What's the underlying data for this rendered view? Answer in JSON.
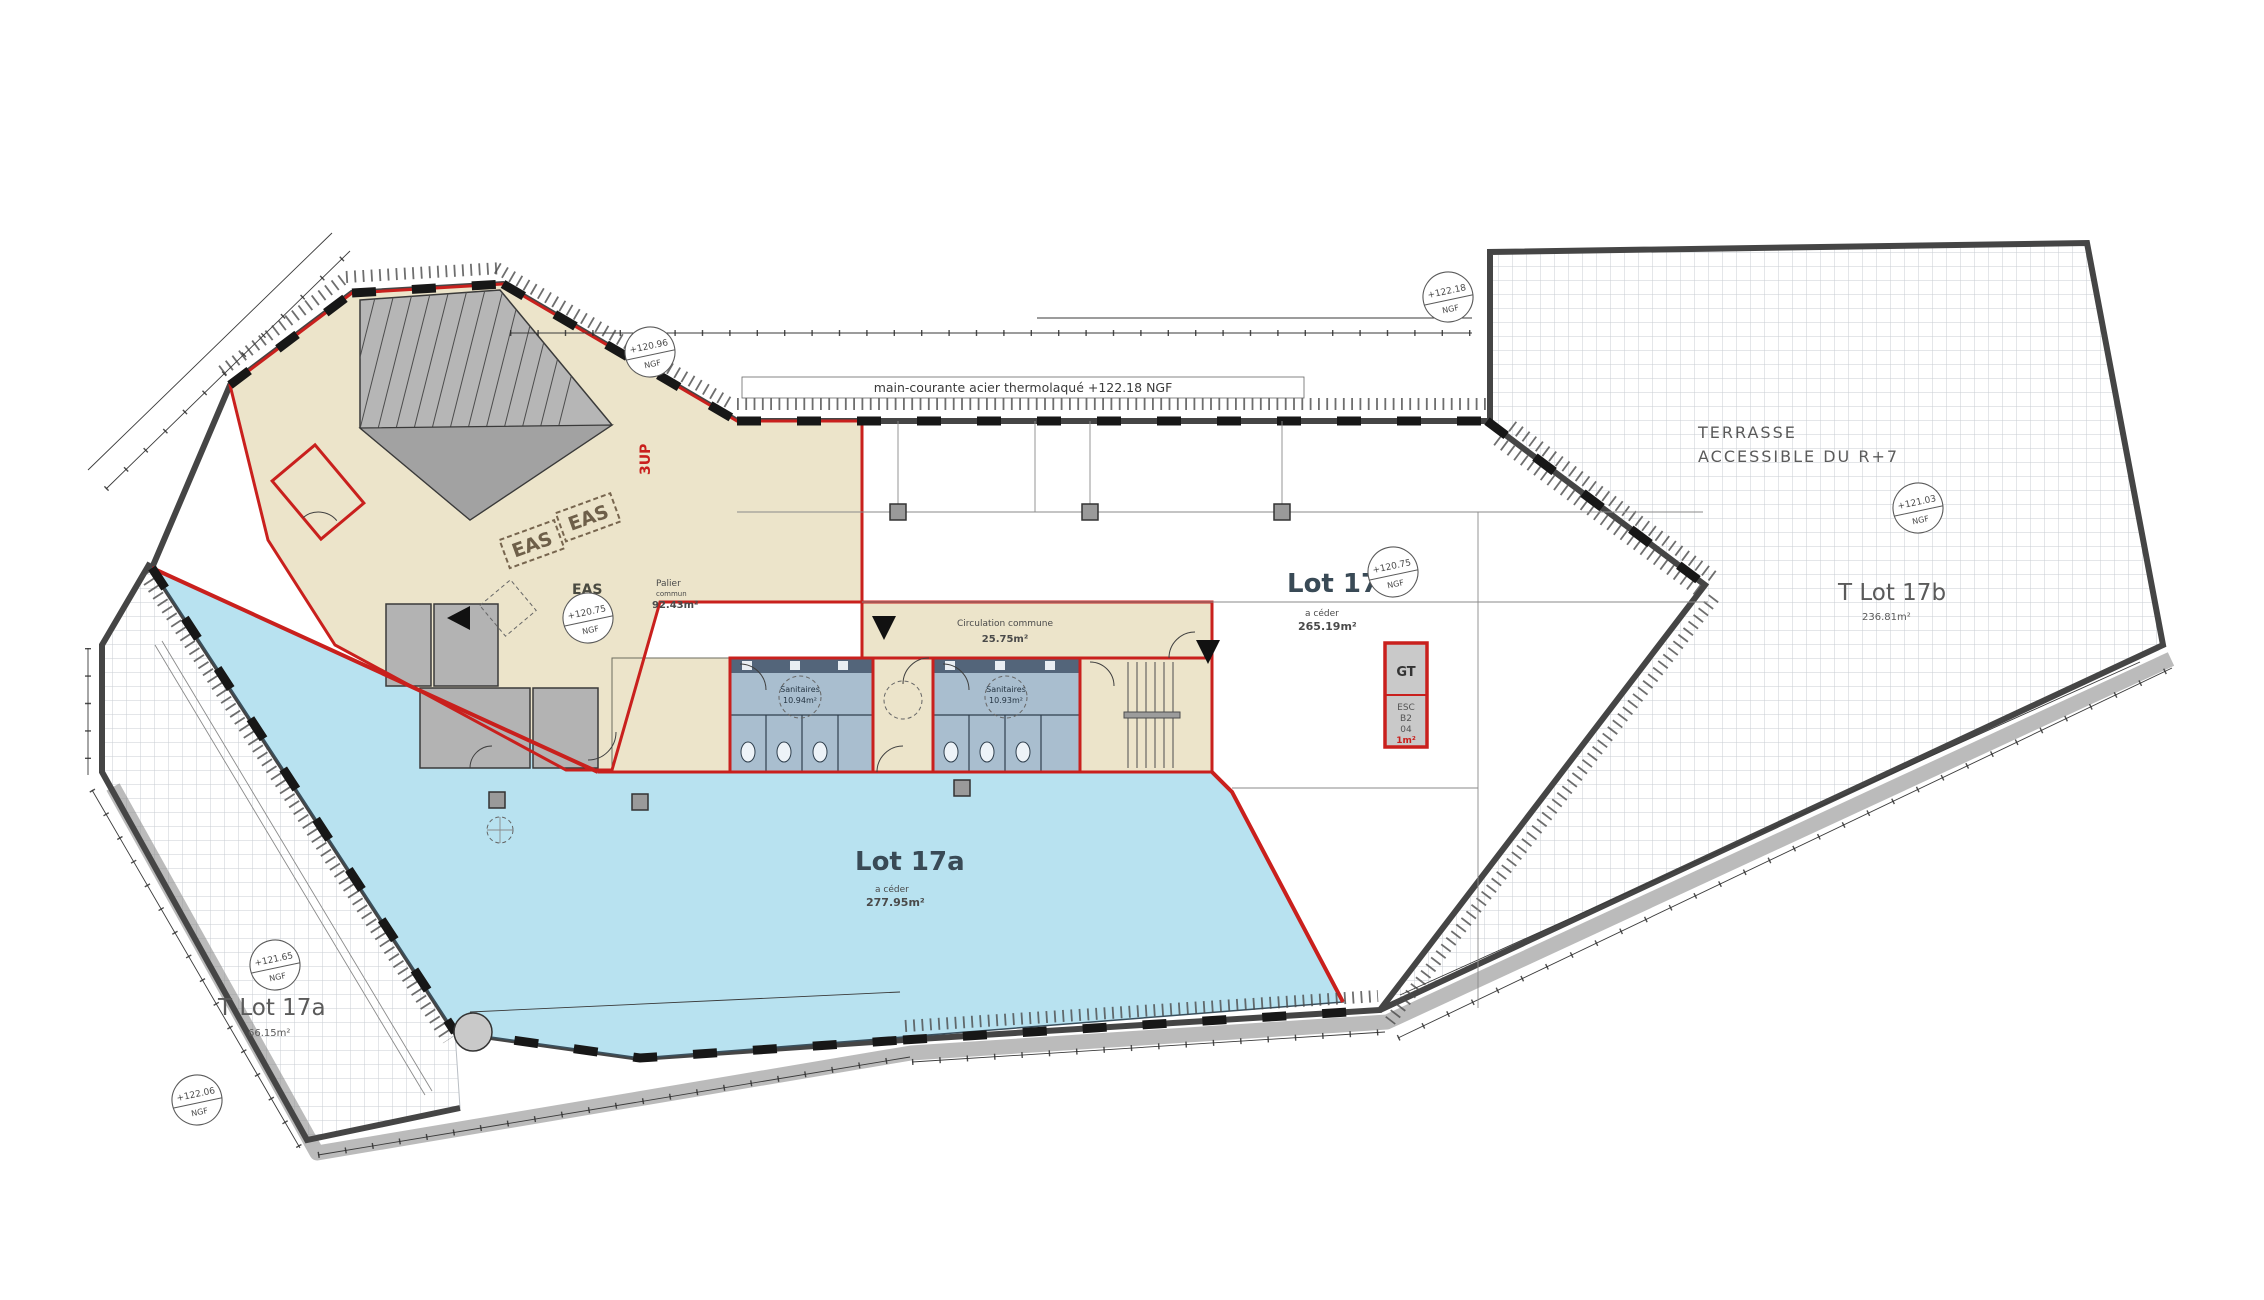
{
  "drawing": {
    "railing_note": "main-courante acier thermolaqué +122.18 NGF",
    "colors": {
      "lot17a_fill": "#b8e2f0",
      "common_beige": "#ece4ca",
      "boundary_red": "#c9201d",
      "wall_gray": "#454545",
      "sanitary_fill": "#a9becf"
    },
    "labels": {
      "lot17a": {
        "name": "Lot 17a",
        "sub": "a céder",
        "area": "277.95m²"
      },
      "lot17b": {
        "name": "Lot 17b",
        "sub": "a céder",
        "area": "265.19m²"
      },
      "t17b": {
        "label": "T Lot 17b",
        "area": "236.81m²"
      },
      "t17a": {
        "label": "T Lot 17a",
        "area": "66.15m²"
      },
      "terrasse": {
        "line1": "TERRASSE",
        "line2": "ACCESSIBLE  DU R+7"
      },
      "eas": "EAS",
      "eas_stamp": "EAS",
      "palier": {
        "name": "Palier",
        "sub": "commun",
        "area": "92.43m²"
      },
      "circulation": {
        "name": "Circulation commune",
        "area": "25.75m²"
      },
      "sanitaires_left": {
        "name": "Sanitaires",
        "area": "10.94m²"
      },
      "sanitaires_right": {
        "name": "Sanitaires",
        "area": "10.93m²"
      },
      "gt": {
        "label": "GT",
        "l1": "ESC",
        "l2": "B2",
        "l3": "04",
        "l4": "1m²"
      },
      "stair_direction": "3UP"
    },
    "stamps": [
      {
        "value": "+120.96",
        "unit": "NGF"
      },
      {
        "value": "+120.75",
        "unit": "NGF"
      },
      {
        "value": "+120.75",
        "unit": "NGF"
      },
      {
        "value": "+121.03",
        "unit": "NGF"
      },
      {
        "value": "+121.65",
        "unit": "NGF"
      },
      {
        "value": "+122.06",
        "unit": "NGF"
      },
      {
        "value": "+122.18",
        "unit": "NGF"
      }
    ]
  }
}
